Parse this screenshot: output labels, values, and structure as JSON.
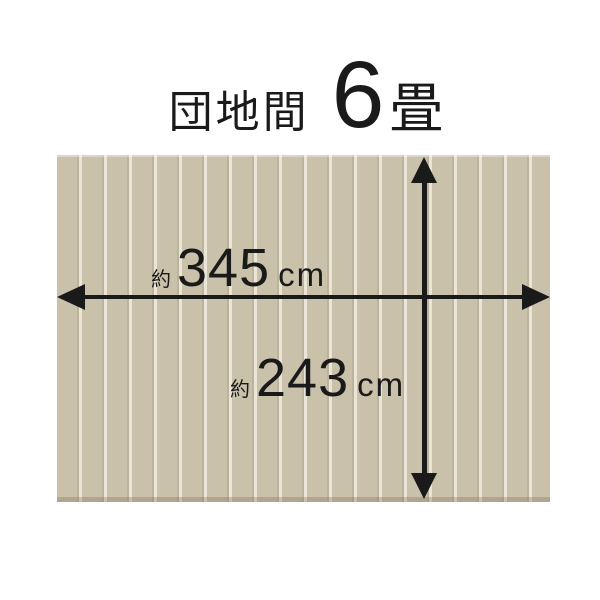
{
  "title": {
    "room_type": "団地間",
    "tatami_count": "6",
    "tatami_unit": "畳"
  },
  "diagram": {
    "type": "room-size-diagram",
    "dimensions": {
      "width_cm": 345,
      "height_cm": 243,
      "approximate": true
    },
    "width_label": {
      "prefix": "約",
      "value": "345",
      "unit": "cm"
    },
    "height_label": {
      "prefix": "約",
      "value": "243",
      "unit": "cm"
    },
    "colors": {
      "page_bg": "#ffffff",
      "plank": "#cac1ab",
      "plank_edge": "#bcb39c",
      "divider": "#ebe5d7",
      "arrow": "#1a1a1a",
      "text": "#1a1a1a"
    }
  }
}
